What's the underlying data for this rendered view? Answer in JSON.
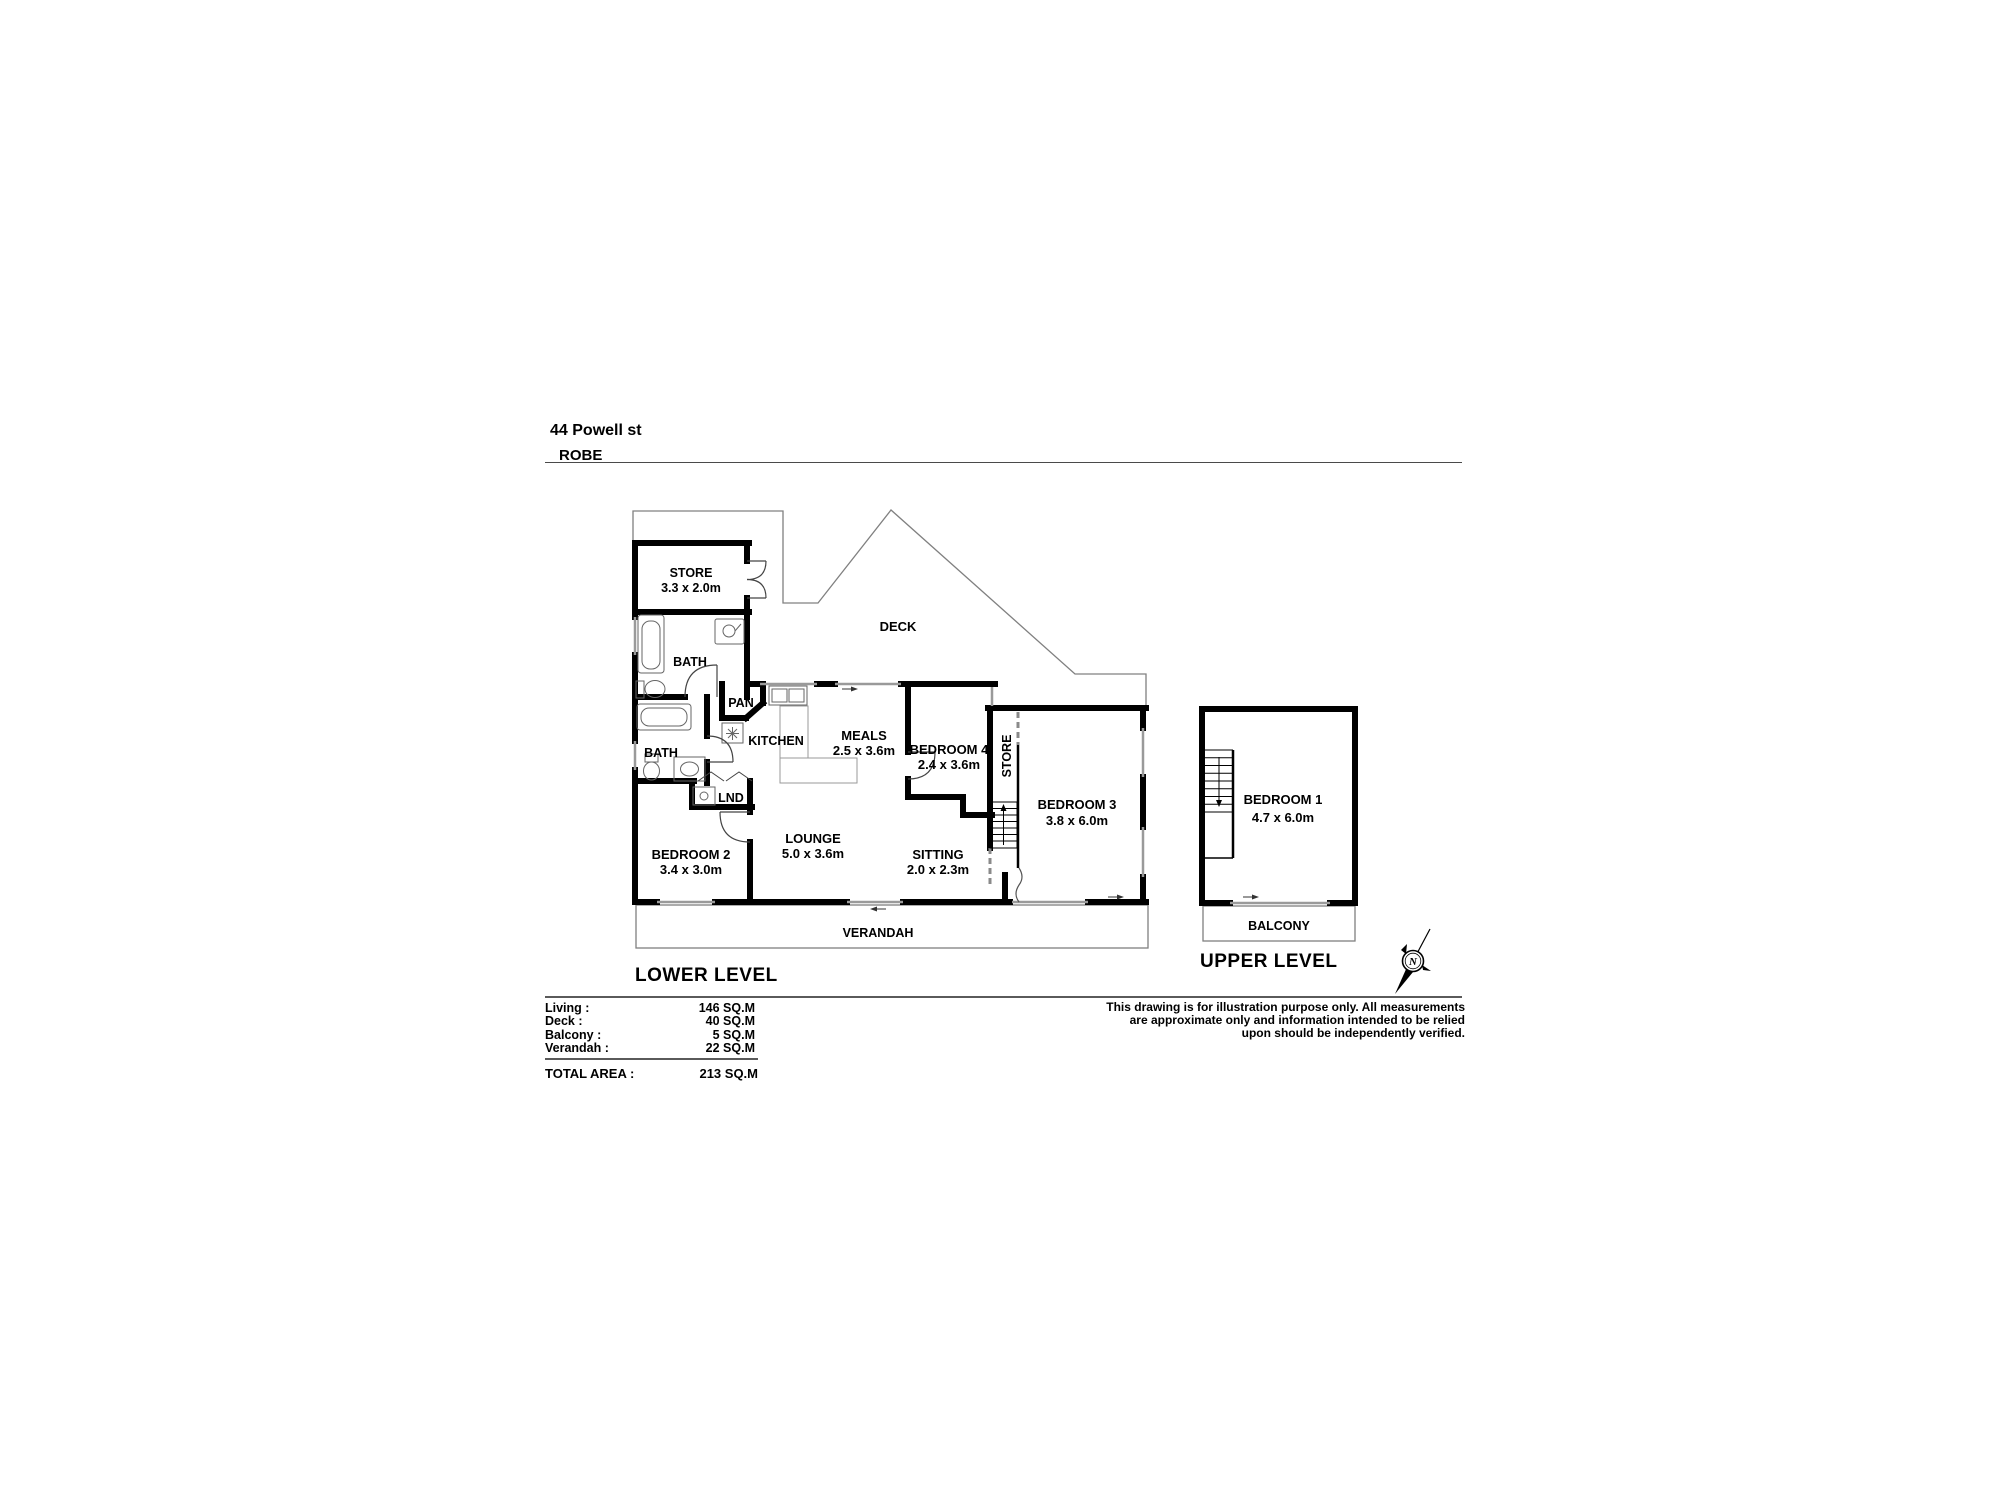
{
  "title": {
    "address": "44 Powell st",
    "suburb": "ROBE"
  },
  "levels": {
    "lower": "LOWER LEVEL",
    "upper": "UPPER LEVEL"
  },
  "rooms": {
    "store": {
      "name": "STORE",
      "dims": "3.3 x 2.0m"
    },
    "bath_top": {
      "name": "BATH"
    },
    "deck": {
      "name": "DECK"
    },
    "pan": {
      "name": "PAN"
    },
    "kitchen": {
      "name": "KITCHEN"
    },
    "meals": {
      "name": "MEALS",
      "dims": "2.5 x 3.6m"
    },
    "bedroom4": {
      "name": "BEDROOM 4",
      "dims": "2.4 x 3.6m"
    },
    "hall_store": {
      "name": "STORE"
    },
    "bedroom3": {
      "name": "BEDROOM 3",
      "dims": "3.8 x 6.0m"
    },
    "bath_lower": {
      "name": "BATH"
    },
    "lnd": {
      "name": "LND"
    },
    "bedroom2": {
      "name": "BEDROOM 2",
      "dims": "3.4 x 3.0m"
    },
    "lounge": {
      "name": "LOUNGE",
      "dims": "5.0 x 3.6m"
    },
    "sitting": {
      "name": "SITTING",
      "dims": "2.0 x 2.3m"
    },
    "verandah": {
      "name": "VERANDAH"
    },
    "bedroom1": {
      "name": "BEDROOM 1",
      "dims": "4.7 x 6.0m"
    },
    "balcony": {
      "name": "BALCONY"
    }
  },
  "areas": {
    "rows": [
      {
        "label": "Living :",
        "value": "146 SQ.M"
      },
      {
        "label": "Deck :",
        "value": "40 SQ.M"
      },
      {
        "label": "Balcony :",
        "value": "5 SQ.M"
      },
      {
        "label": "Verandah :",
        "value": "22 SQ.M"
      }
    ],
    "total_label": "TOTAL AREA :",
    "total_value": "213 SQ.M"
  },
  "disclaimer": {
    "line1": "This drawing is for illustration purpose only. All measurements",
    "line2": "are approximate only and information intended to be relied",
    "line3": "upon should be independently verified."
  },
  "compass": {
    "north": "N"
  },
  "colors": {
    "wall": "#000000",
    "outline": "#808080",
    "window": "#9a9a9a",
    "background": "#ffffff"
  }
}
